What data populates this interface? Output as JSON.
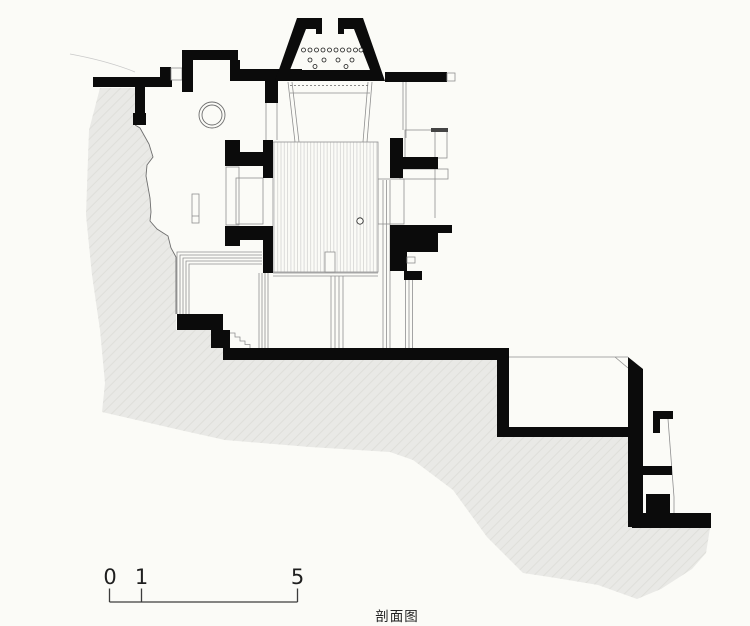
{
  "drawing": {
    "caption": "剖面图",
    "kind": "architectural-section-drawing",
    "scale_bar": {
      "labels": [
        "0",
        "1",
        "5"
      ]
    },
    "colors": {
      "bg": "#fbfbf7",
      "terrain": "#e9e9e6",
      "hatch": "#dfdfda",
      "ink": "#0b0b0b",
      "line": "#8f8f8f",
      "line_light": "#c9c9c9",
      "text": "#1f1f1f"
    }
  }
}
